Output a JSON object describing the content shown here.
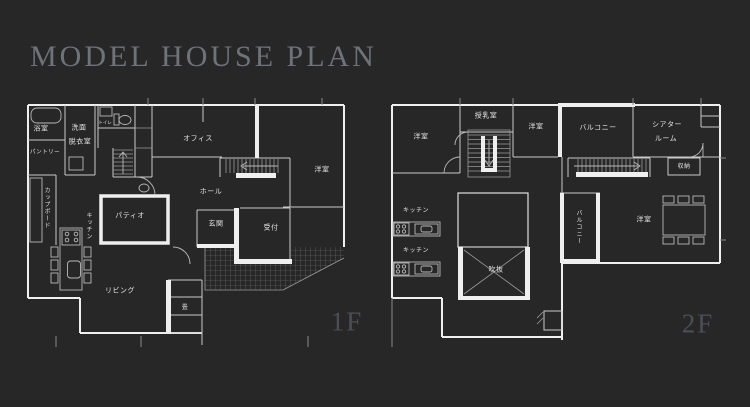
{
  "title": "MODEL HOUSE PLAN",
  "colors": {
    "background": "#272727",
    "wall": "#efefef",
    "title_text": "#6e737b",
    "floor_label_text": "#4b4f55",
    "room_label_text": "#e3e3e3"
  },
  "floor1": {
    "floor_label": "1F",
    "rooms": {
      "bath": "浴室",
      "washroom_line1": "洗面",
      "washroom_line2": "脱衣室",
      "toilet": "トイレ",
      "pantry": "パントリー",
      "cupboard": "カップボード",
      "kitchen": "キッチン",
      "office": "オフィス",
      "bedroom": "洋室",
      "hall": "ホール",
      "patio": "パティオ",
      "entrance": "玄関",
      "reception": "受付",
      "living": "リビング",
      "tatami": "畳"
    }
  },
  "floor2": {
    "floor_label": "2F",
    "rooms": {
      "bedroom_top_left": "洋室",
      "nursing": "授乳室",
      "bedroom_top_center": "洋室",
      "balcony_top": "バルコニー",
      "theater_line1": "シアター",
      "theater_line2": "ルーム",
      "storage": "収納",
      "kitchen_1": "キッチン",
      "kitchen_2": "キッチン",
      "void": "吹抜",
      "balcony_side": "バルコニー",
      "bedroom_right": "洋室"
    }
  }
}
